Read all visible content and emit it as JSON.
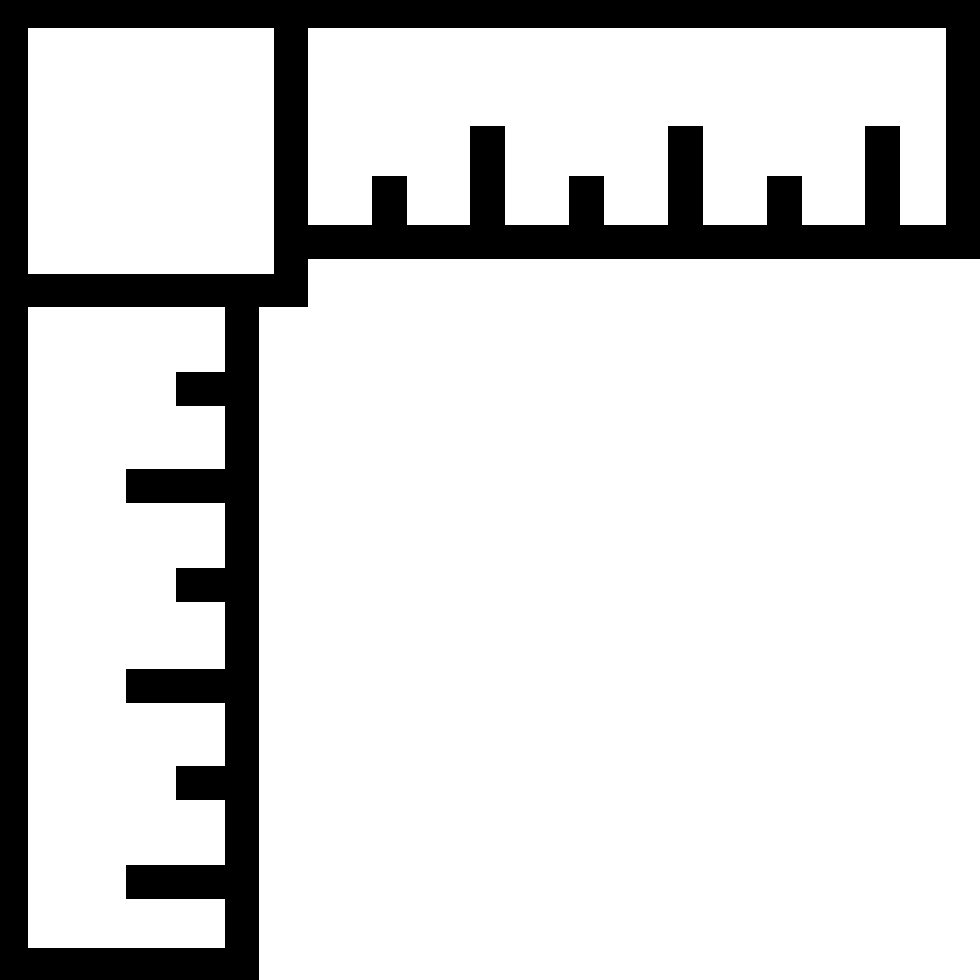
{
  "icon": {
    "name": "carpenter-square-icon",
    "description": "Black and white L-shaped carpenter's framing square icon: a square corner block at top-left, a horizontal ruler arm across the top with alternating short and long tick marks pointing up from its bottom edge, and a vertical ruler arm down the left side with alternating short and long tick marks pointing left from its right edge",
    "colors": {
      "foreground": "#000000",
      "background": "#ffffff"
    },
    "canvas": {
      "width": 980,
      "height": 980
    },
    "corner_block": {
      "interior": {
        "left": 28,
        "top": 28,
        "right": 274,
        "bottom": 274
      },
      "outer": {
        "left": 0,
        "top": 0,
        "right": 307,
        "bottom": 307
      }
    },
    "horizontal_ruler": {
      "interior": {
        "left": 307,
        "top": 27,
        "right": 946,
        "bottom": 225
      },
      "tick_width": 35,
      "short_tick_top": 176,
      "long_tick_top": 126,
      "baseline": 259,
      "tick_count": 6,
      "tick_pattern": [
        "short",
        "long",
        "short",
        "long",
        "short",
        "long"
      ],
      "ticks": [
        {
          "x": 372,
          "size": "short"
        },
        {
          "x": 470,
          "size": "long"
        },
        {
          "x": 569,
          "size": "short"
        },
        {
          "x": 668,
          "size": "long"
        },
        {
          "x": 767,
          "size": "short"
        },
        {
          "x": 865,
          "size": "long"
        }
      ]
    },
    "vertical_ruler": {
      "interior": {
        "left": 28,
        "top": 307,
        "right": 225,
        "bottom": 948
      },
      "tick_height": 34,
      "short_tick_left": 176,
      "long_tick_left": 126,
      "right_edge": 259,
      "tick_count": 6,
      "tick_pattern": [
        "short",
        "long",
        "short",
        "long",
        "short",
        "long"
      ],
      "ticks": [
        {
          "y": 372,
          "size": "short"
        },
        {
          "y": 469,
          "size": "long"
        },
        {
          "y": 568,
          "size": "short"
        },
        {
          "y": 669,
          "size": "long"
        },
        {
          "y": 766,
          "size": "short"
        },
        {
          "y": 865,
          "size": "long"
        }
      ]
    }
  }
}
